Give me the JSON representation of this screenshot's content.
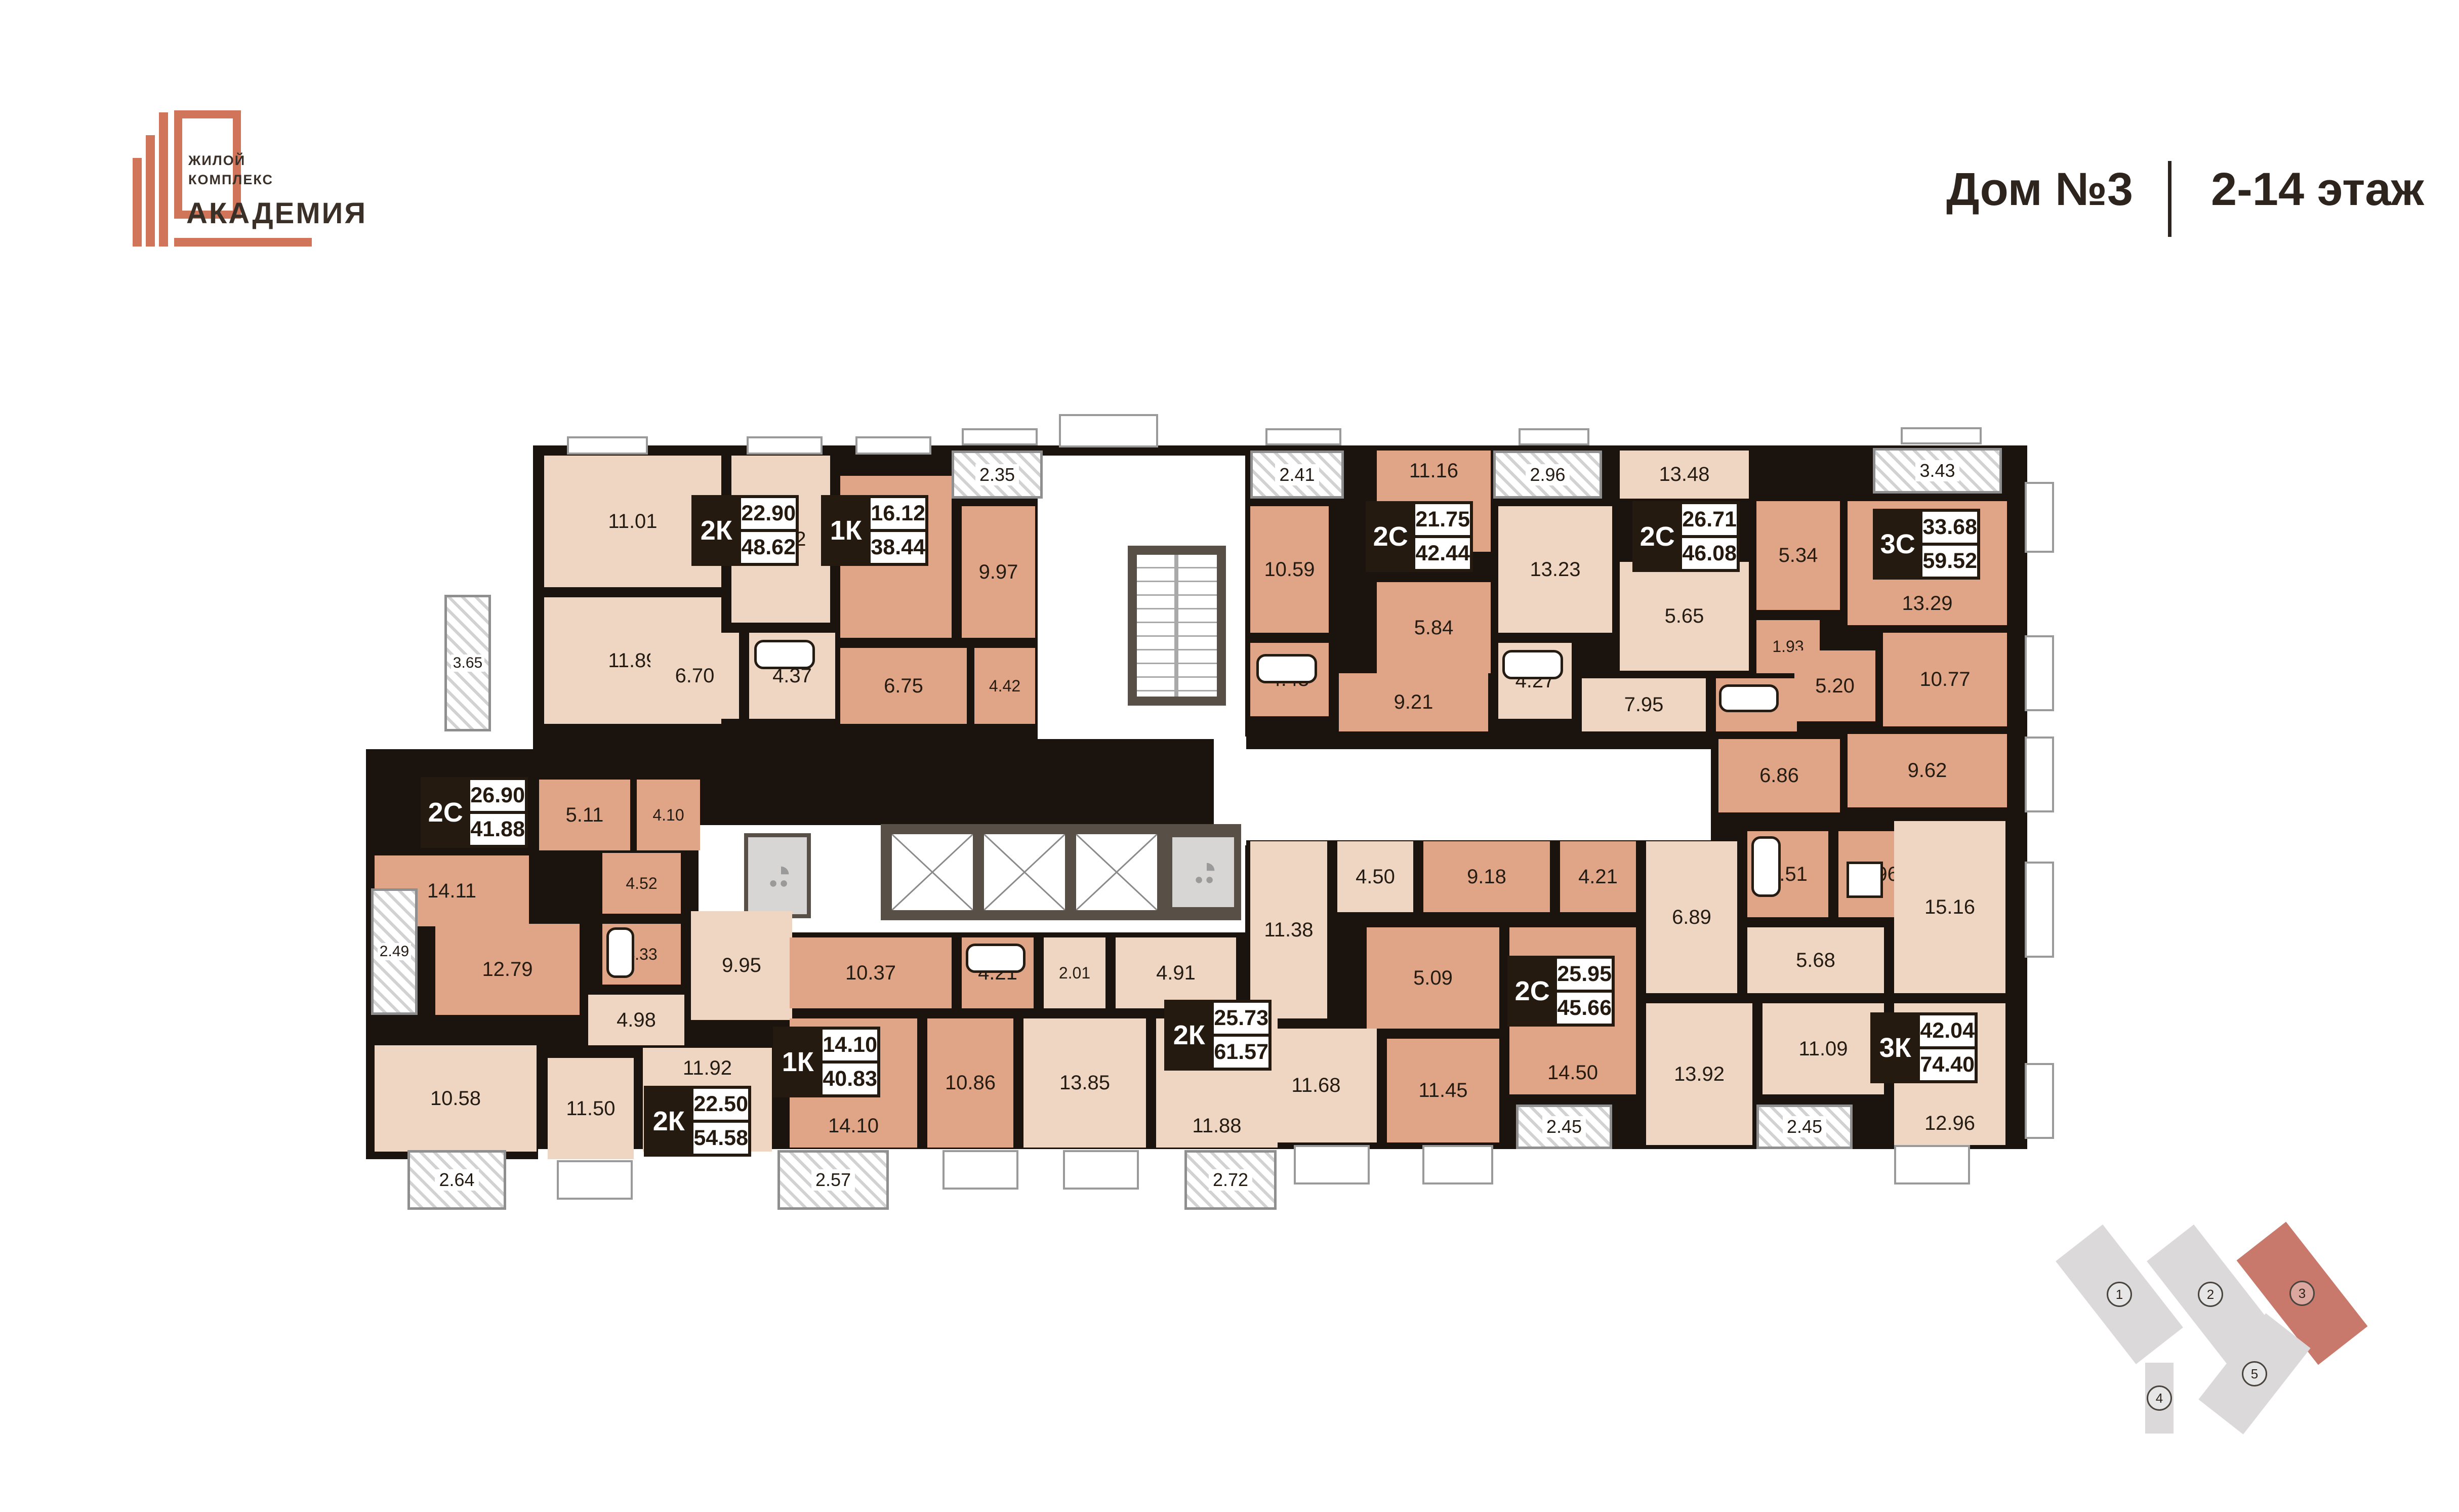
{
  "logo": {
    "line1": "ЖИЛОЙ",
    "line2": "КОМПЛЕКС",
    "name": "АКАДЕМИЯ"
  },
  "header": {
    "building": "Дом №3",
    "floors": "2-14 этаж"
  },
  "plan": {
    "apartments": [
      {
        "type": "2К",
        "room_area": "22.90",
        "total_area": "48.62"
      },
      {
        "type": "1К",
        "room_area": "16.12",
        "total_area": "38.44"
      },
      {
        "type": "2С",
        "room_area": "21.75",
        "total_area": "42.44"
      },
      {
        "type": "2С",
        "room_area": "26.71",
        "total_area": "46.08"
      },
      {
        "type": "3С",
        "room_area": "33.68",
        "total_area": "59.52"
      },
      {
        "type": "2С",
        "room_area": "26.90",
        "total_area": "41.88"
      },
      {
        "type": "2К",
        "room_area": "22.50",
        "total_area": "54.58"
      },
      {
        "type": "1К",
        "room_area": "14.10",
        "total_area": "40.83"
      },
      {
        "type": "2К",
        "room_area": "25.73",
        "total_area": "61.57"
      },
      {
        "type": "2С",
        "room_area": "25.95",
        "total_area": "45.66"
      },
      {
        "type": "3К",
        "room_area": "42.04",
        "total_area": "74.40"
      }
    ],
    "rooms": [
      "11.01",
      "11.89",
      "12.82",
      "6.70",
      "4.37",
      "16.12",
      "9.97",
      "6.75",
      "4.42",
      "10.59",
      "11.16",
      "5.84",
      "4.43",
      "9.21",
      "13.23",
      "4.27",
      "7.95",
      "13.48",
      "5.65",
      "5.34",
      "13.29",
      "1.93",
      "5.20",
      "4.79",
      "10.77",
      "9.62",
      "6.86",
      "14.11",
      "5.11",
      "4.10",
      "4.52",
      "12.79",
      "4.33",
      "9.95",
      "4.98",
      "10.58",
      "11.92",
      "11.50",
      "10.37",
      "4.21",
      "14.10",
      "10.86",
      "2.01",
      "4.91",
      "13.85",
      "11.88",
      "11.38",
      "4.50",
      "9.18",
      "4.21",
      "5.09",
      "14.50",
      "11.45",
      "11.68",
      "6.89",
      "4.51",
      "2.96",
      "5.68",
      "15.16",
      "13.92",
      "11.09",
      "12.96"
    ],
    "balconies": [
      "2.35",
      "2.41",
      "2.96",
      "3.43",
      "3.65",
      "2.49",
      "2.64",
      "2.57",
      "2.72",
      "2.45",
      "2.45"
    ],
    "site_plan": {
      "buildings": [
        "1",
        "2",
        "3",
        "4",
        "5"
      ],
      "highlighted": "3"
    }
  },
  "colors": {
    "accent_orange": "#d0755a",
    "wall": "#1b140e",
    "room_light": "#efd6c2",
    "room_salmon": "#e0a586",
    "site_highlight": "#c9796b",
    "plate_dark": "#241a10"
  }
}
